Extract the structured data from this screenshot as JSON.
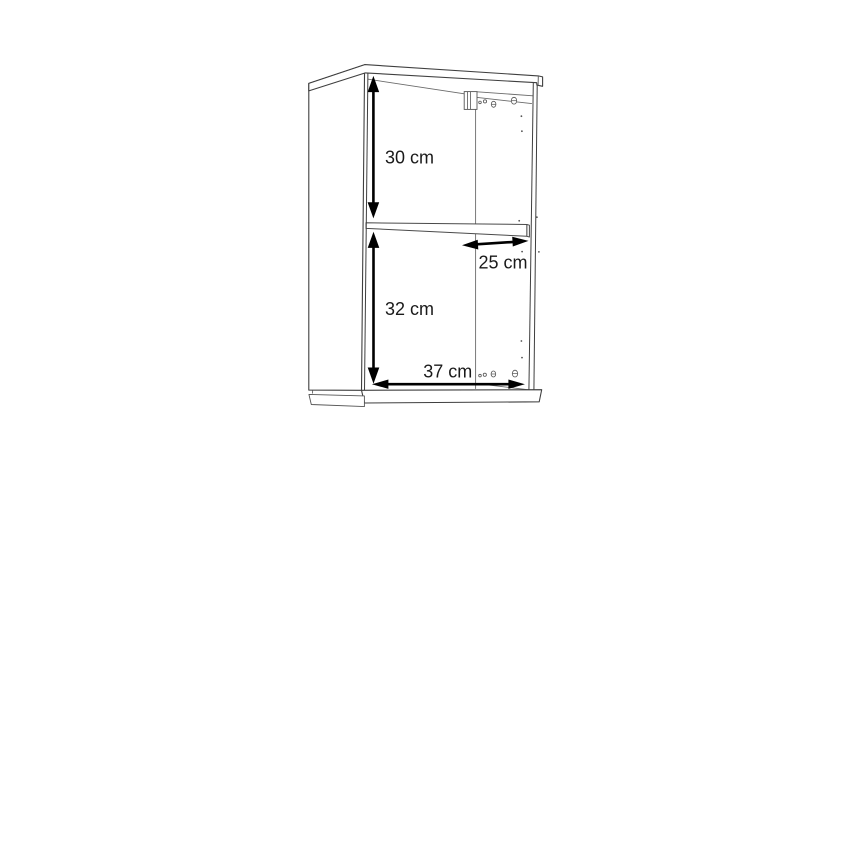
{
  "diagram": {
    "title": "wall-cabinet-dimension-drawing",
    "object": "open two-compartment wall cabinet with middle shelf",
    "colors": {
      "background": "#ffffff",
      "outline": "#3f3f3f",
      "interior_line": "#6b6b6b",
      "arrow": "#000000",
      "label_text": "#1a1a1a"
    },
    "dimensions": [
      {
        "id": "upper-compartment-height",
        "label": "30 cm",
        "value": 30,
        "unit": "cm",
        "orientation": "vertical"
      },
      {
        "id": "shelf-depth",
        "label": "25 cm",
        "value": 25,
        "unit": "cm",
        "orientation": "horizontal"
      },
      {
        "id": "lower-compartment-height",
        "label": "32 cm",
        "value": 32,
        "unit": "cm",
        "orientation": "vertical"
      },
      {
        "id": "interior-width",
        "label": "37 cm",
        "value": 37,
        "unit": "cm",
        "orientation": "horizontal"
      }
    ]
  }
}
